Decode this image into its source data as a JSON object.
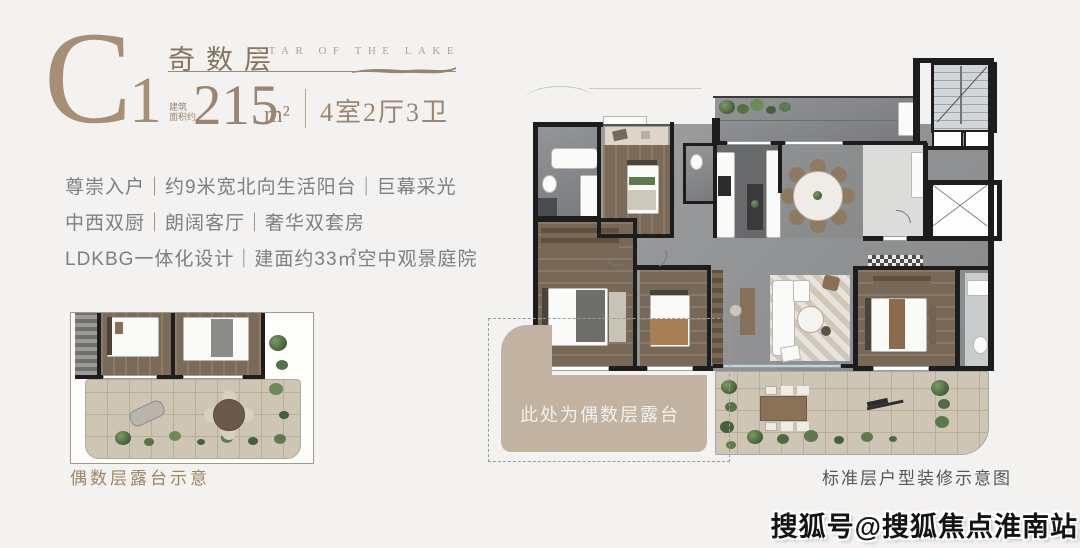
{
  "header": {
    "unit_letter": "C",
    "unit_digit": "1",
    "floor_type": "奇数层",
    "project_en": "STAR OF THE LAKE",
    "area_prefix_line1": "建筑",
    "area_prefix_line2": "面积约",
    "area_value": "215",
    "area_unit": "m²",
    "room_config": "4室2厅3卫"
  },
  "features": {
    "lines": [
      "尊崇入户｜约9米宽北向生活阳台｜巨幕采光",
      "中西双厨｜朗阔客厅｜奢华双套房",
      "LDKBG一体化设计｜建面约33㎡空中观景庭院"
    ]
  },
  "inset": {
    "caption": "偶数层露台示意"
  },
  "plan": {
    "terrace_note": "此处为偶数层露台",
    "caption": "标准层户型装修示意图"
  },
  "watermark": {
    "text": "搜狐号@搜狐焦点淮南站"
  },
  "colors": {
    "brand": "#9b8570",
    "feature_text": "#7f7f7f",
    "wall": "#1d1d1e",
    "terrace_tan": "#c1b2a2",
    "caption_brown": "#9b8467",
    "caption_gray": "#565656"
  }
}
